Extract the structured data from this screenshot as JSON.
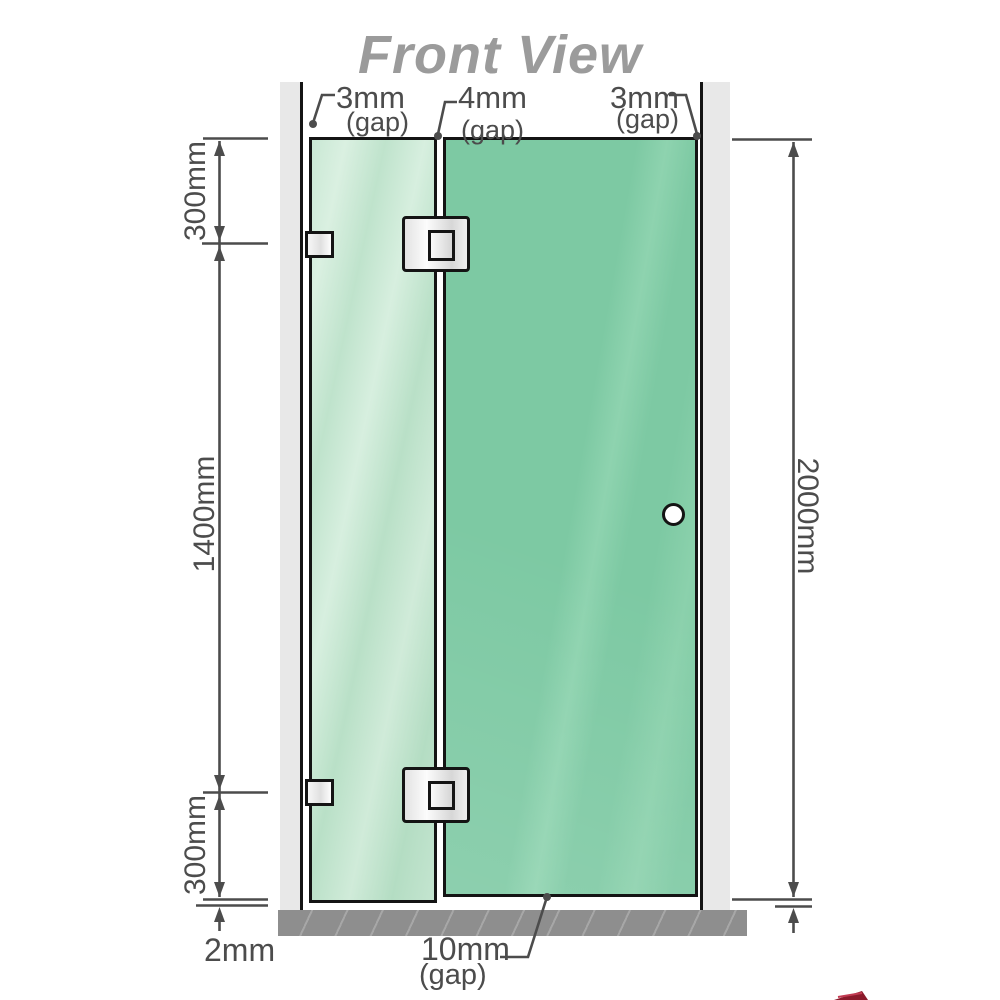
{
  "title": "Front View",
  "top_gap_labels": [
    {
      "value": "3mm",
      "note": "(gap)"
    },
    {
      "value": "4mm",
      "note": "(gap)"
    },
    {
      "value": "3mm",
      "note": "(gap)"
    }
  ],
  "left_dimensions": {
    "top": "300mm",
    "middle": "1400mm",
    "bottom": "300mm",
    "floor_gap": "2mm"
  },
  "right_dimensions": {
    "total": "2000mm"
  },
  "bottom_gap_label": {
    "value": "10mm",
    "note": "(gap)"
  },
  "colors": {
    "title_gray": "#9b9b9b",
    "dimension_gray": "#4c4c4c",
    "outline_black": "#141414",
    "glass_door_green": "#7cc9a3",
    "glass_fixed_green": "#c9e8d4",
    "wall_gray": "#e8e8e8",
    "floor_gray": "#8e8e8e",
    "logo_red": "#8b1a2b"
  }
}
